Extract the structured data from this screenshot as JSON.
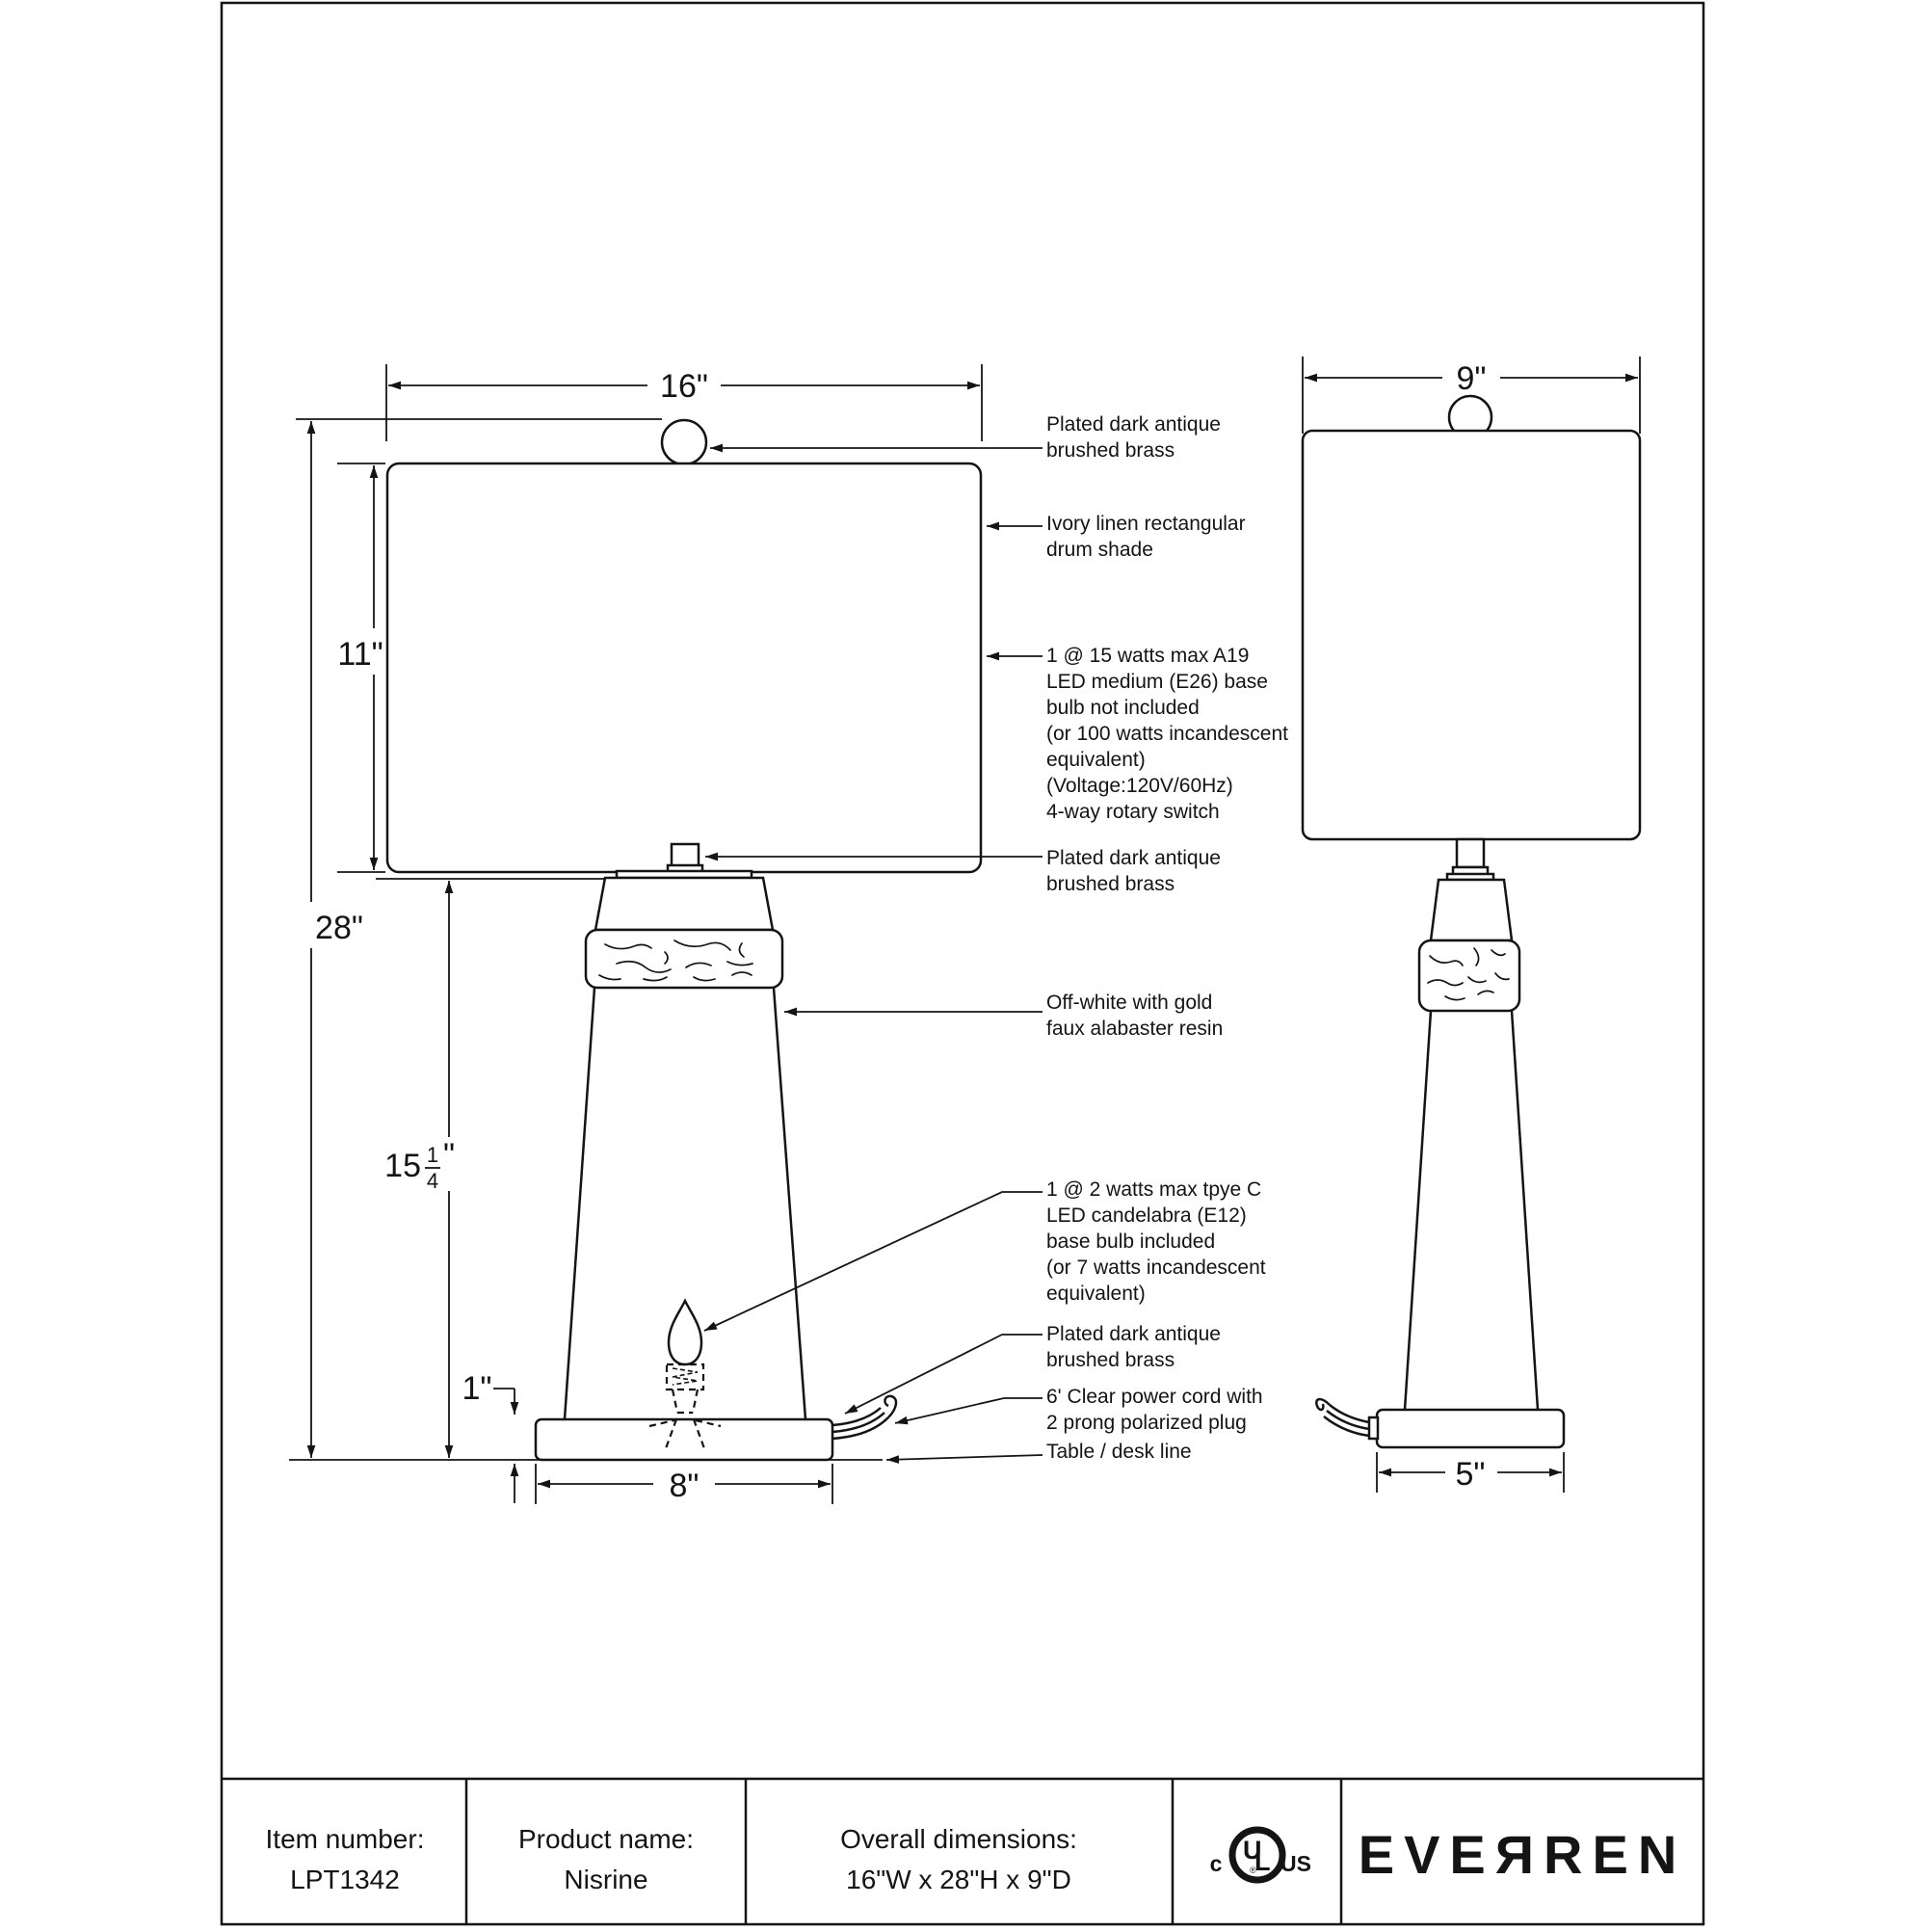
{
  "document": {
    "type": "lamp specification drawing",
    "line_color": "#141414",
    "background": "#ffffff"
  },
  "dimensions": {
    "shade_front_width": "16\"",
    "shade_side_width": "9\"",
    "shade_height": "11\"",
    "overall_height": "28\"",
    "body_height": {
      "whole": "15",
      "numerator": "1",
      "denominator": "4",
      "unit": "\""
    },
    "base_height": "1\"",
    "base_front_width": "8\"",
    "base_side_width": "5\""
  },
  "annotations": {
    "finial": [
      "Plated dark antique",
      "brushed brass"
    ],
    "shade": [
      "Ivory linen rectangular",
      "drum shade"
    ],
    "main_bulb": [
      "1 @ 15 watts max A19",
      "LED medium (E26) base",
      "bulb not included",
      "(or 100 watts incandescent",
      "equivalent)",
      "(Voltage:120V/60Hz)",
      "4-way rotary switch"
    ],
    "neck": [
      "Plated dark antique",
      "brushed brass"
    ],
    "body": [
      "Off-white with gold",
      "faux alabaster resin"
    ],
    "night_bulb": [
      "1 @ 2 watts max tpye C",
      "LED candelabra (E12)",
      "base bulb included",
      "(or 7 watts incandescent",
      "equivalent)"
    ],
    "base": [
      "Plated dark antique",
      "brushed brass"
    ],
    "cord": [
      "6' Clear power cord with",
      "2 prong polarized plug"
    ],
    "desk": [
      "Table / desk line"
    ]
  },
  "footer": {
    "item_number_label": "Item number:",
    "item_number_value": "LPT1342",
    "product_name_label": "Product name:",
    "product_name_value": "Nisrine",
    "overall_dimensions_label": "Overall dimensions:",
    "overall_dimensions_value": "16\"W x 28\"H x 9\"D",
    "certification": {
      "c_mark": "c",
      "u": "U",
      "l": "L",
      "us": "US",
      "registered": "®"
    },
    "brand": "EVEЯREN"
  }
}
